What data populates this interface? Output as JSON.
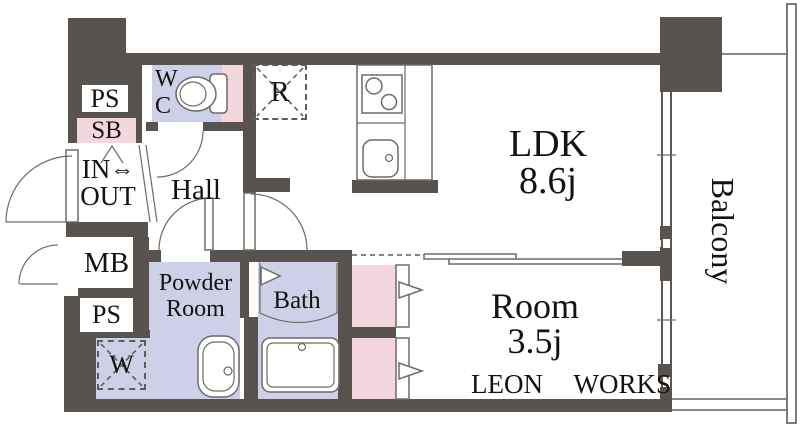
{
  "branding": {
    "logo": "LEON WORKS"
  },
  "rooms": {
    "ldk": {
      "name": "LDK",
      "area": "8.6j"
    },
    "bedroom": {
      "name": "Room",
      "area": "3.5j"
    },
    "balcony": {
      "name": "Balcony"
    },
    "hall": {
      "name": "Hall"
    },
    "powder_room": {
      "name_line1": "Powder",
      "name_line2": "Room"
    },
    "bath": {
      "name": "Bath"
    },
    "toilet": {
      "name_line1": "W",
      "name_line2": "C"
    },
    "entry": {
      "in_label": "IN",
      "arrow": "⇔",
      "out_label": "OUT"
    }
  },
  "utilities": {
    "pipe_space_top": "PS",
    "shoe_box": "SB",
    "meter_box": "MB",
    "pipe_space_bottom": "PS",
    "washing_machine": "W",
    "refrigerator": "R"
  },
  "colors": {
    "wall": "#59534f",
    "wet_floor": "#cdd0e7",
    "accent_pink": "#f4d6de",
    "outline": "#6e6a66"
  }
}
